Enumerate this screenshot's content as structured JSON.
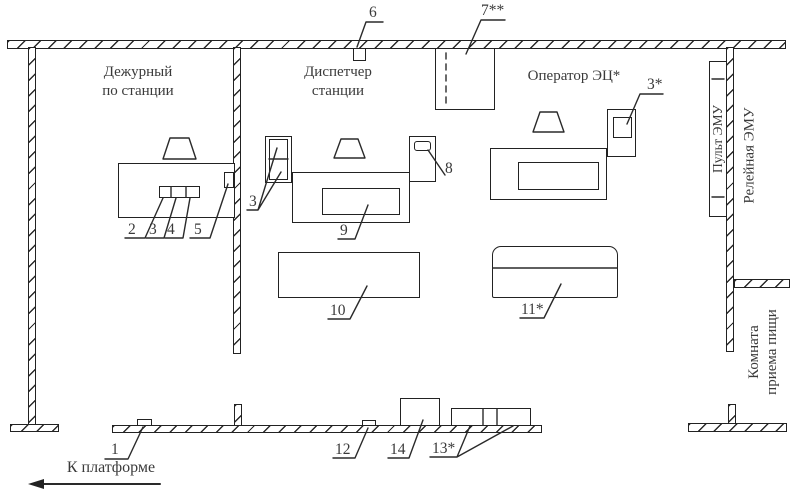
{
  "rooms": {
    "duty_officer": {
      "line1": "Дежурный",
      "line2": "по станции"
    },
    "dispatcher": {
      "line1": "Диспетчер",
      "line2": "станции"
    },
    "operator": {
      "label": "Оператор ЭЦ*"
    },
    "emu_console": {
      "label": "Пульт ЭМУ"
    },
    "emu_relay": {
      "label": "Релейная ЭМУ"
    },
    "meal_room": {
      "line1": "Комната",
      "line2": "приема пищи"
    }
  },
  "callouts": {
    "c1": "1",
    "c2": "2",
    "c3": "3",
    "c4": "4",
    "c5": "5",
    "c6": "6",
    "c7": "7**",
    "c8": "8",
    "c9": "9",
    "c10": "10",
    "c11": "11*",
    "c12": "12",
    "c13": "13*",
    "c14": "14",
    "c3_dispatcher": "3",
    "c3_operator": "3*"
  },
  "platform": {
    "label": "К платформе"
  },
  "colors": {
    "line": "#222222",
    "text": "#3a3a3a",
    "background": "#ffffff"
  }
}
